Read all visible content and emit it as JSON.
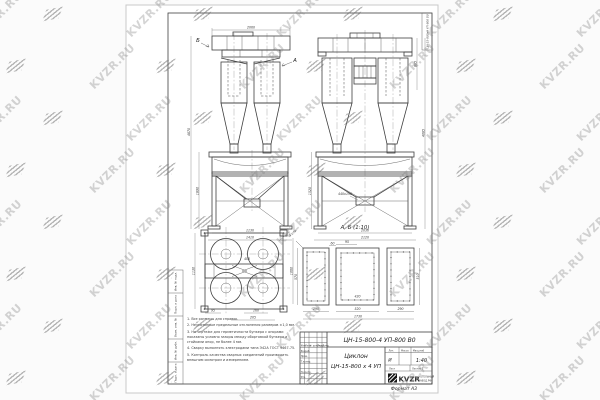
{
  "watermark": {
    "text": "KVZR.RU"
  },
  "sheet": {
    "corner_stamp": "ЦН-15-800х4 УП-800 В0",
    "format_note": "Формат  А3"
  },
  "title_block": {
    "designation": "ЦН-15-800-4 УП-800  В0",
    "product_name_line1": "Циклон",
    "product_name_line2": "ЦН-15-800 х 4 УП",
    "lit_label": "Лит.",
    "mass_label": "Масса",
    "scale_label": "Масштаб",
    "lit_value": "И",
    "scale_value": "1:40",
    "sheet_label": "Лист",
    "sheets_label": "Листов 1",
    "company": {
      "logo_text": "KVZR",
      "tagline_line1": "КОТЕЛЬНЫЙ",
      "tagline_line2": "ЗАВОД.РФ"
    },
    "sign_rows": [
      "Разраб.",
      "Пров.",
      "Т.контр.",
      "Н.контр.",
      "Утв."
    ],
    "change_headers": [
      "Изм.",
      "Лист",
      "№ докум.",
      "Подп.",
      "Дата"
    ]
  },
  "margin_stamps": [
    "Инв. № подл.",
    "Подп. и дата",
    "Взам. инв. №",
    "Инв. № дубл.",
    "Подп. и дата"
  ],
  "notes": {
    "lines": [
      "1. Все размеры для справок.",
      "2. Неуказанные предельные отклонения размеров ±1,0 мм.",
      "3. На чертеже для герметичности бункера с опорами показаны условно зазоры между обортовкой бункера и стойками опор, не более 4 мм.",
      "4. Сварку выполнять электродами типа Э42А ГОСТ 9467-75.",
      "5. Контроль качества сварных соединений производить внешним осмотром и измерением."
    ]
  },
  "view_labels": {
    "b_arrow": "Б",
    "a_arrow": "А",
    "detail": "А, Б (1:10)"
  },
  "dims": {
    "front_width": "2060",
    "front_frame_w1": "1130",
    "front_frame_w2": "1410",
    "front_total_h": "4870",
    "front_frame_h": "1890",
    "side_top_h": "885",
    "side_total_h": "4085",
    "side_frame_h": "1520",
    "side_frame_w1": "2030",
    "side_frame_w2": "2120",
    "hopper_outlet": "440х190",
    "plan_depth": "1130",
    "plan_width": "1060",
    "plan_d1": "95",
    "plan_d2": "160",
    "plan_d3": "205",
    "plan_duct": "405",
    "plan_holes": "4 отв.",
    "fl_left_w": "290",
    "fl_mid_w": "520",
    "fl_right_w": "290",
    "fl_total_w": "1730",
    "fl_left_h": "570",
    "fl_right_h": "510",
    "fl_d60": "60",
    "fl_d95": "95",
    "fl_mid_inner": "420"
  }
}
